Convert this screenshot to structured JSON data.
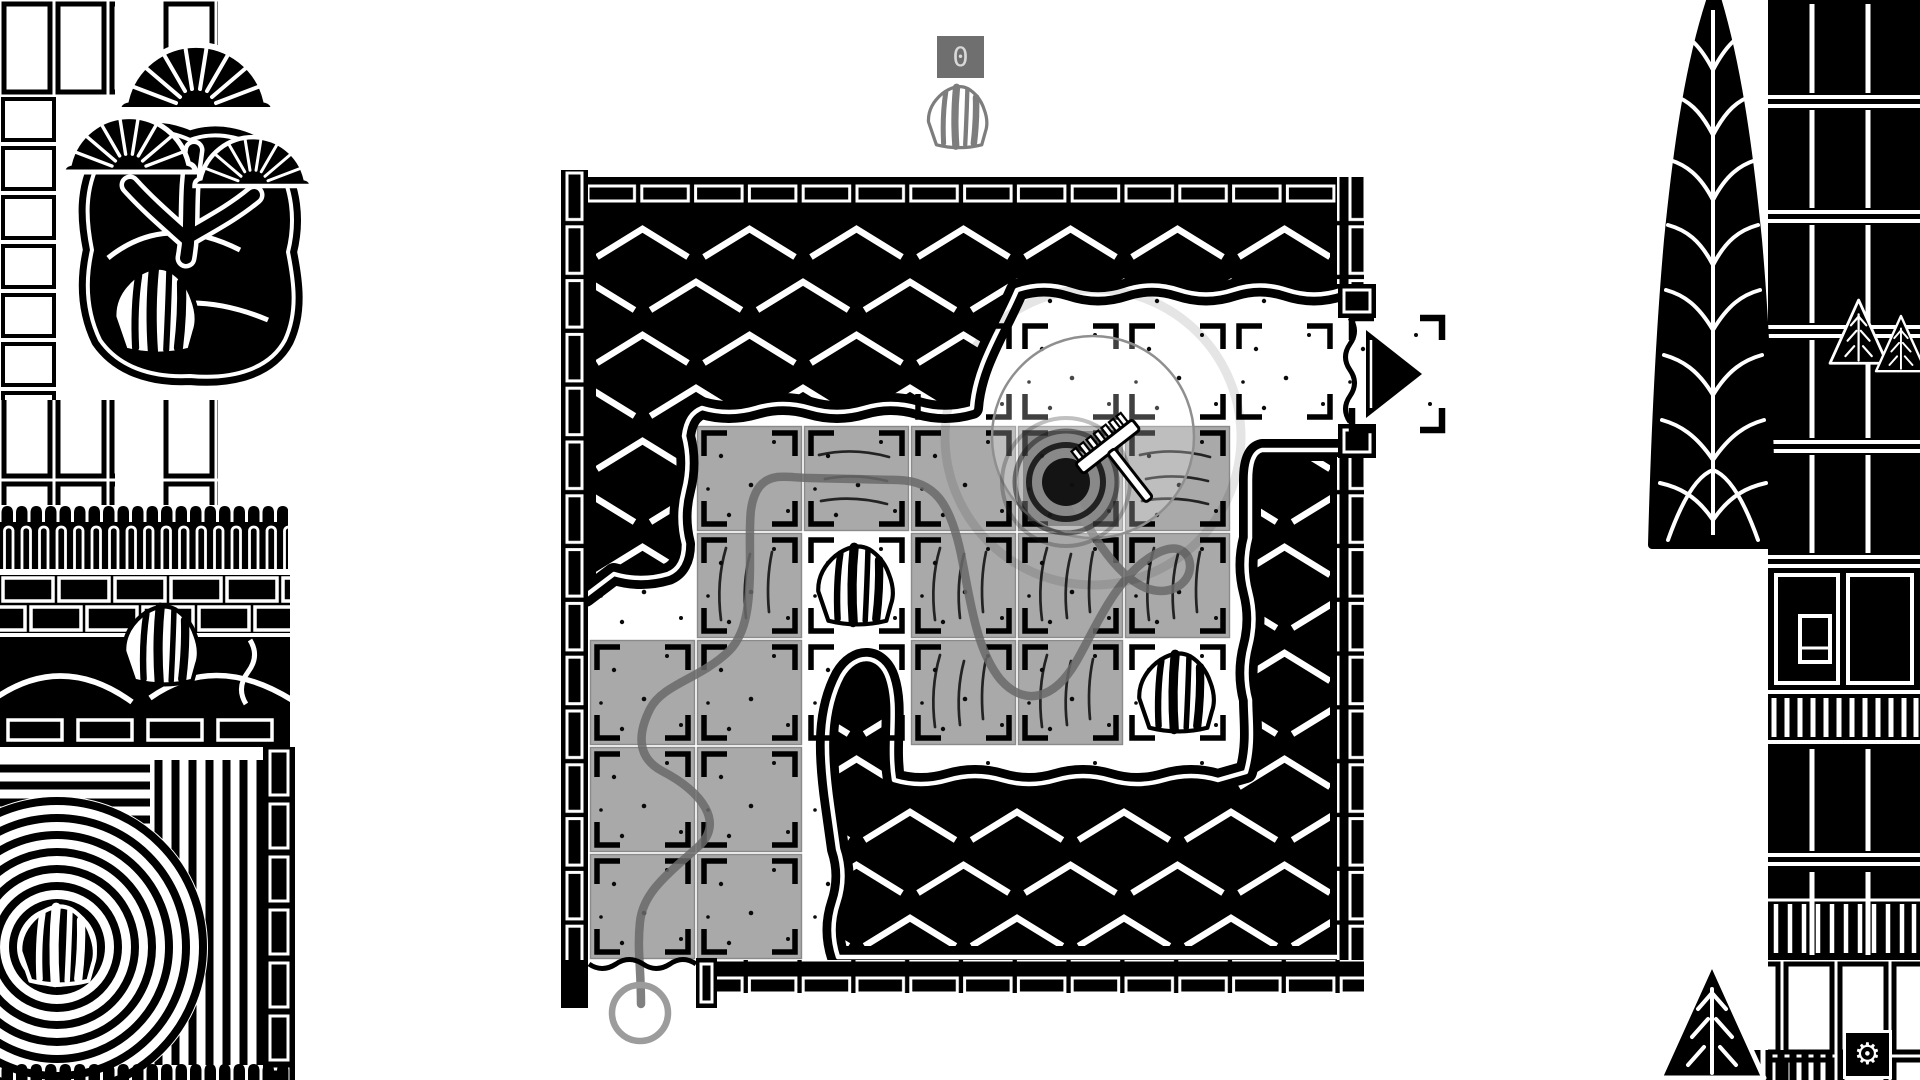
{
  "hud": {
    "rocks_counter": "0",
    "counter_box_color": "#6f6f6f",
    "counter_text_color": "#d8d8d8",
    "gear_icon": "⚙",
    "rock_icon": "boulder-outline"
  },
  "colors": {
    "ink": "#000000",
    "paper": "#ffffff",
    "tile_gray": "#a9a9a9",
    "path_gray": "#6a6a6a",
    "marker_gray": "#9c9c9c"
  },
  "board": {
    "grid_legend": {
      "B": "unraked-black",
      "W": "raked-white",
      "G": "traversed-gray",
      "R": "rock-cell",
      "A": "active-raking-cell",
      "X": "white-cell-with-black-mound"
    },
    "grid": [
      "BBBBBBB",
      "BBBWWWW",
      "BGGGAGB",
      "BGRGGGB",
      "GGXGGRB",
      "GGBBBBB",
      "GGBBBBB"
    ],
    "origin_x": 589,
    "origin_y": 211,
    "cell": 107,
    "rocks": [
      [
        3,
        2
      ],
      [
        4,
        5
      ]
    ],
    "scratches": [
      [
        2,
        2,
        "h"
      ],
      [
        2,
        5,
        "h"
      ],
      [
        3,
        1,
        "v"
      ],
      [
        3,
        3,
        "v"
      ],
      [
        3,
        4,
        "v"
      ],
      [
        3,
        5,
        "v"
      ],
      [
        4,
        3,
        "v"
      ],
      [
        4,
        4,
        "v"
      ]
    ],
    "active_cell": [
      2,
      4
    ],
    "rake_path_d": "M641,1004 C641,966 637,950 640,922 C643,892 668,874 699,846 C724,823 703,792 662,771 C636,757 638,733 650,709 C663,684 700,679 729,651 C747,633 750,602 750,562 C750,522 748,501 760,486 C772,472 789,478 810,478 L898,480 C934,481 950,502 961,554 C970,599 976,649 1000,679 C1024,707 1054,700 1076,662 C1094,631 1110,590 1142,563 C1164,546 1180,544 1188,557 C1197,577 1175,599 1146,588 C1113,575 1085,522 1068,490",
    "start_marker": {
      "x": 640,
      "y": 1013,
      "r": 28
    },
    "exit": {
      "arrow": "right",
      "cell": [
        1,
        6
      ]
    }
  }
}
